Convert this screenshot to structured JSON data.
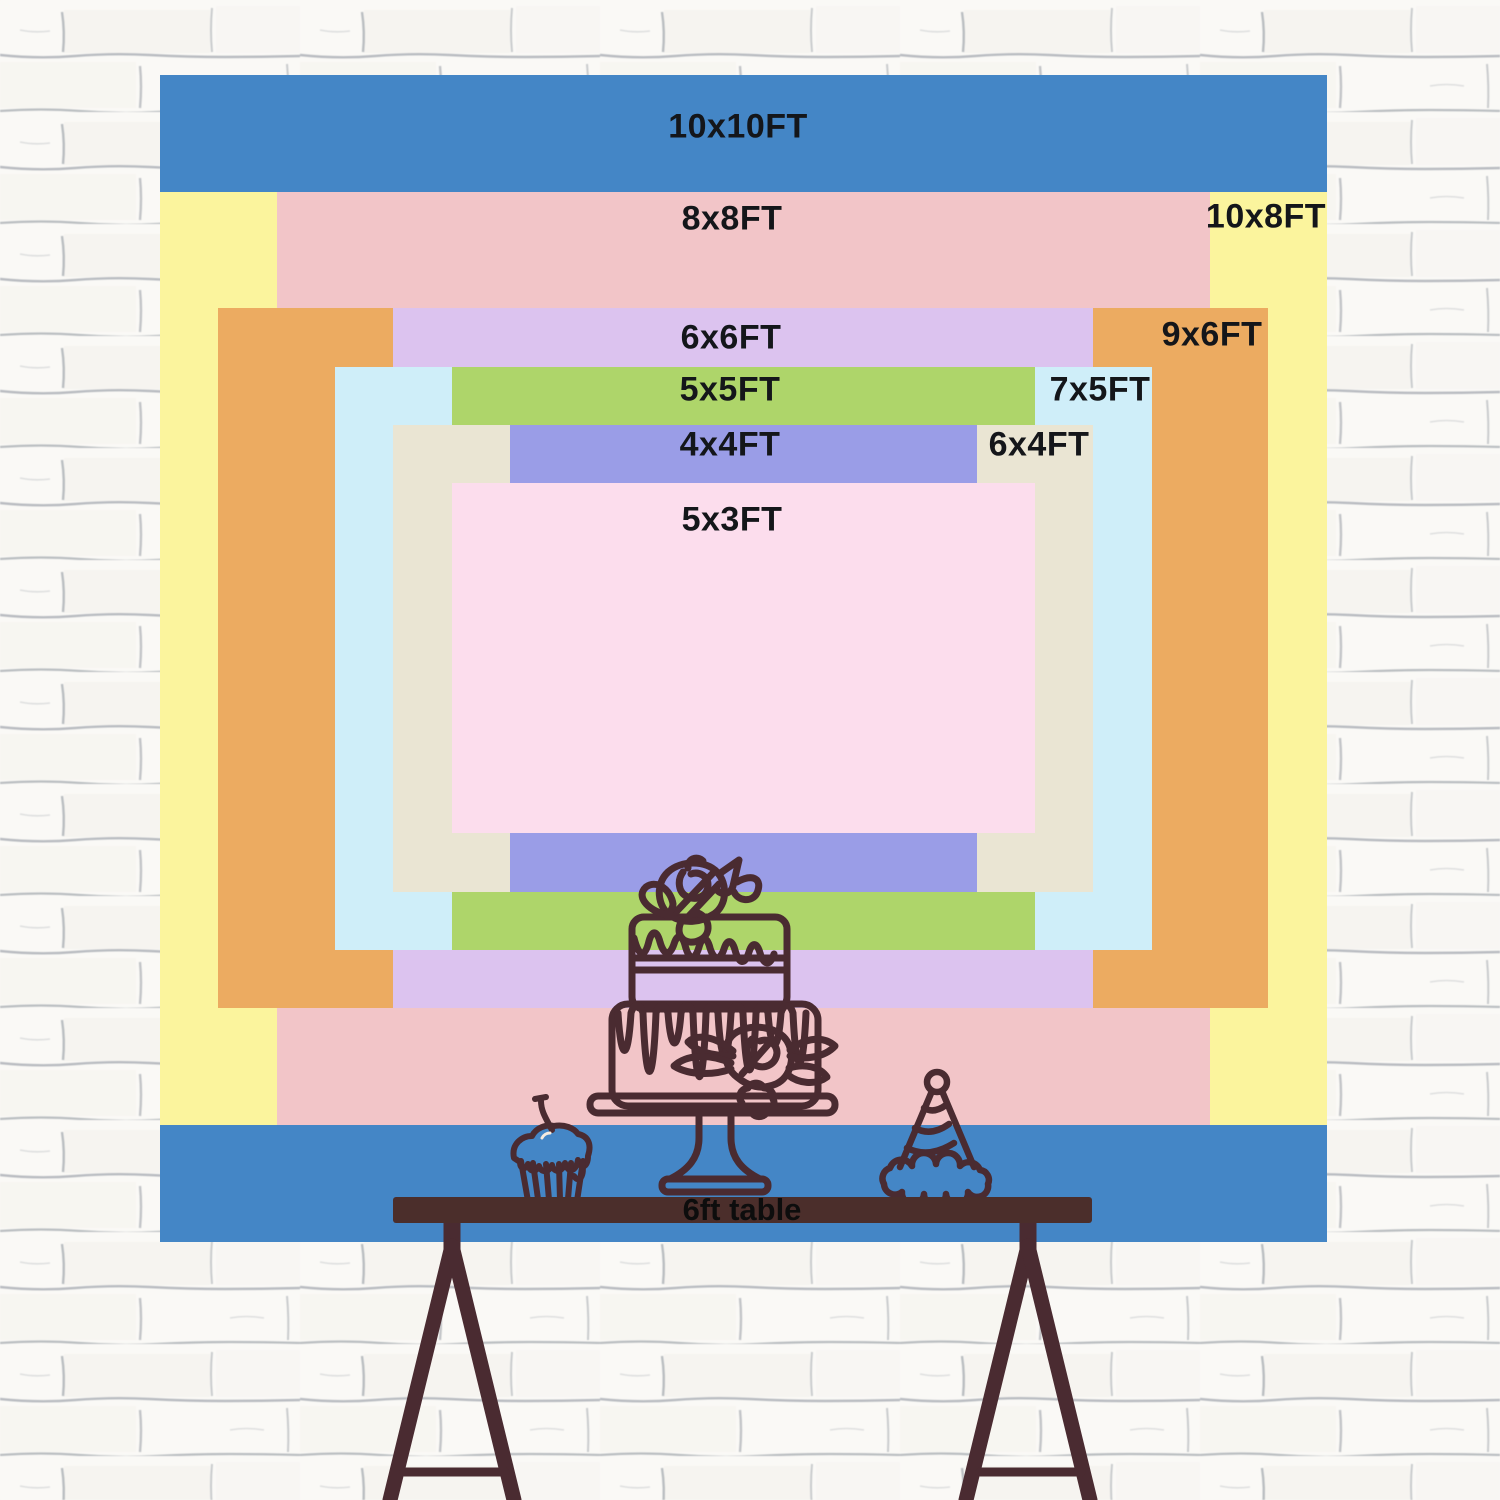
{
  "backdrop": {
    "description_labels_unit": "FT",
    "sizes": [
      {
        "label": "10x10FT",
        "color": "#4486c6"
      },
      {
        "label": "10x8FT",
        "color": "#fbf49d"
      },
      {
        "label": "8x8FT",
        "color": "#f2c5c8"
      },
      {
        "label": "9x6FT",
        "color": "#ecab61"
      },
      {
        "label": "6x6FT",
        "color": "#dcc3ef"
      },
      {
        "label": "7x5FT",
        "color": "#cfeef9"
      },
      {
        "label": "5x5FT",
        "color": "#aed56a"
      },
      {
        "label": "6x4FT",
        "color": "#eae5d3"
      },
      {
        "label": "4x4FT",
        "color": "#9a9de7"
      },
      {
        "label": "5x3FT",
        "color": "#fcdded"
      }
    ]
  },
  "table": {
    "label": "6ft table",
    "color": "#4b2e2b"
  },
  "illustration": {
    "line_color": "#4a2b31"
  },
  "wall": {
    "base_color": "#faf9f6",
    "mortar_line_color": "#6d7580"
  }
}
